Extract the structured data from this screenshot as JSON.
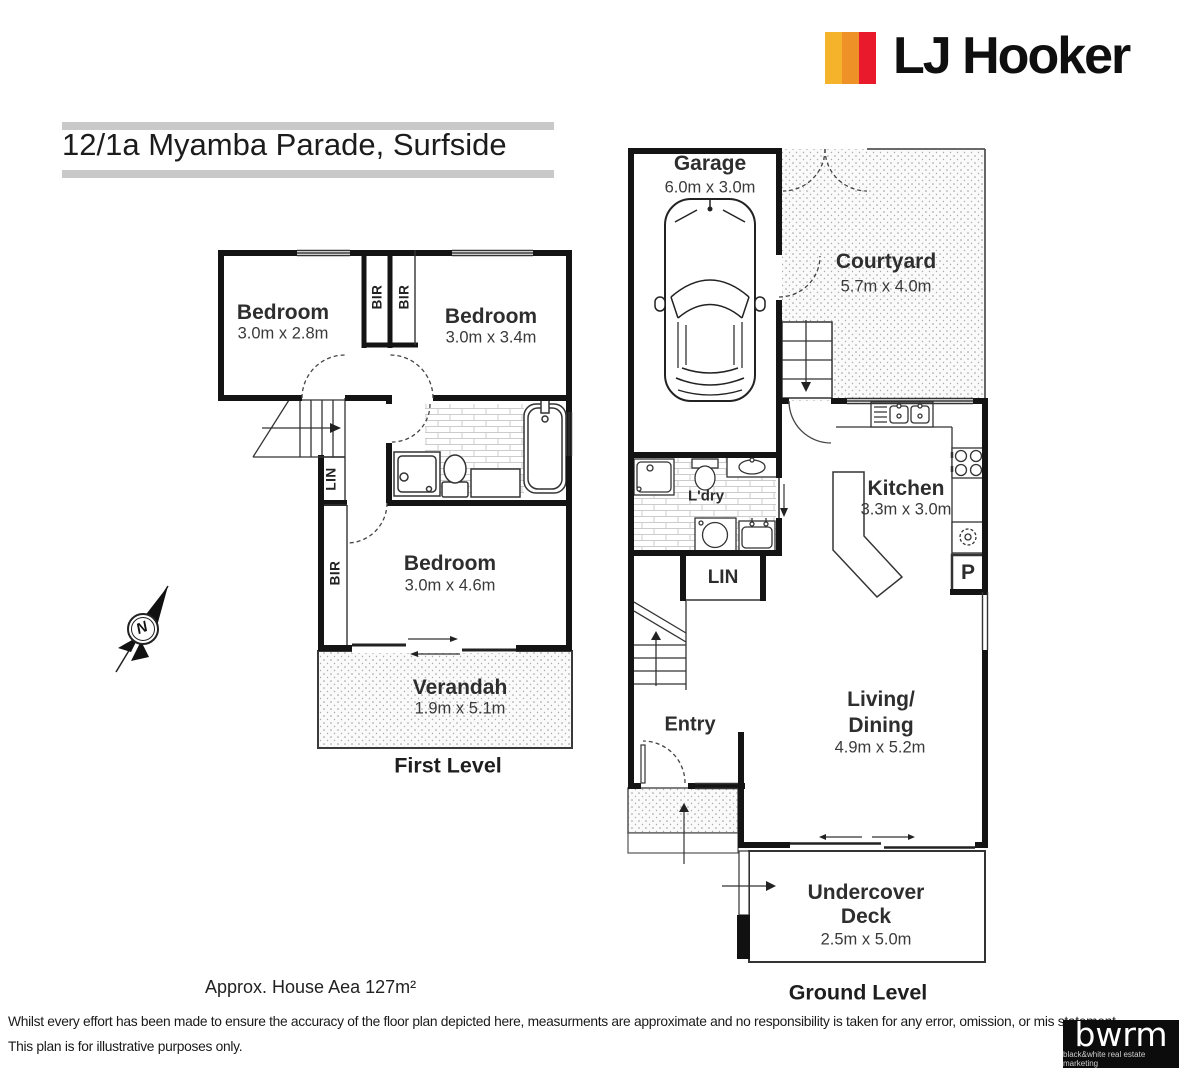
{
  "header": {
    "brand": "LJ Hooker",
    "title": "12/1a Myamba Parade, Surfside"
  },
  "colors": {
    "stripe_yellow": "#F5B32B",
    "stripe_orange": "#EE9127",
    "stripe_red": "#E81A2C"
  },
  "first_level": {
    "title": "First Level",
    "bedroom1_label": "Bedroom",
    "bedroom1_dims": "3.0m x 2.8m",
    "bedroom2_label": "Bedroom",
    "bedroom2_dims": "3.0m x 3.4m",
    "bedroom3_label": "Bedroom",
    "bedroom3_dims": "3.0m x 4.6m",
    "verandah_label": "Verandah",
    "verandah_dims": "1.9m x 5.1m",
    "bir1": "BIR",
    "bir2": "BIR",
    "bir3": "BIR",
    "lin": "LIN"
  },
  "ground_level": {
    "title": "Ground Level",
    "garage_label": "Garage",
    "garage_dims": "6.0m x 3.0m",
    "courtyard_label": "Courtyard",
    "courtyard_dims": "5.7m x 4.0m",
    "kitchen_label": "Kitchen",
    "kitchen_dims": "3.3m x 3.0m",
    "laundry_label": "L'dry",
    "lin": "LIN",
    "pantry": "P",
    "entry": "Entry",
    "living_label_line1": "Living/",
    "living_label_line2": "Dining",
    "living_dims": "4.9m x 5.2m",
    "deck_label_line1": "Undercover",
    "deck_label_line2": "Deck",
    "deck_dims": "2.5m x 5.0m"
  },
  "compass": {
    "north_label": "N"
  },
  "footer": {
    "area_note": "Approx. House Aea 127m²",
    "disclaimer_line1": "Whilst every effort has been made to ensure the accuracy of the floor plan depicted here, measurments are approximate and no responsibility is taken for any error, omission, or mis statement.",
    "disclaimer_line2": "This plan is for illustrative purposes only.",
    "bwrm_brand": "bwrm",
    "bwrm_tagline": "black&white real estate marketing"
  }
}
